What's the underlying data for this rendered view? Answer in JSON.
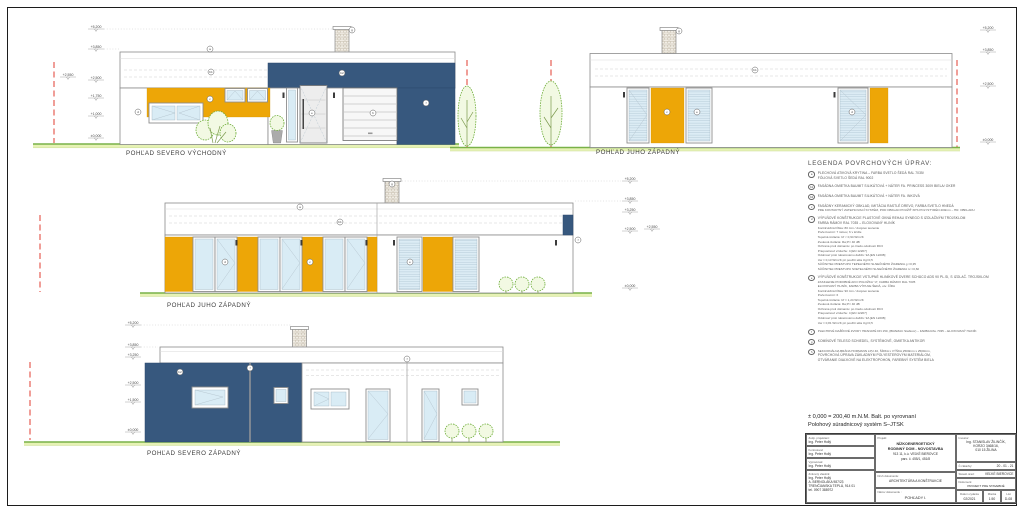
{
  "colors": {
    "facade_blue": "#37587e",
    "facade_yellow": "#eda607",
    "grass_green": "#79b148",
    "boundary_red": "#e23c30"
  },
  "drawing": {
    "elevations": [
      {
        "label": "POHĽAD  SEVERO VÝCHODNÝ"
      },
      {
        "label": "POHĽAD JUHO ZÁPADNÝ"
      },
      {
        "label": "POHĽAD JUHO ZÁPADNÝ"
      },
      {
        "label": "POHĽAD SEVERO ZÁPADNÝ"
      }
    ],
    "level_marks": [
      {
        "x": 96,
        "y": 29,
        "label": "+5,200",
        "leader": [
          104,
          332
        ]
      },
      {
        "x": 96,
        "y": 49,
        "label": "+3,850",
        "leader": [
          104,
          119
        ]
      },
      {
        "x": 68,
        "y": 77,
        "label": "+2,550"
      },
      {
        "x": 96,
        "y": 80,
        "label": "+2,500"
      },
      {
        "x": 96,
        "y": 98,
        "label": "+1,750"
      },
      {
        "x": 96,
        "y": 116,
        "label": "+1,000"
      },
      {
        "x": 96,
        "y": 138,
        "label": "±0,000"
      },
      {
        "x": 988,
        "y": 30,
        "label": "+5,200"
      },
      {
        "x": 988,
        "y": 52,
        "label": "+3,850"
      },
      {
        "x": 988,
        "y": 86,
        "label": "+2,500"
      },
      {
        "x": 988,
        "y": 142,
        "label": "±0,000"
      },
      {
        "x": 630,
        "y": 181,
        "label": "+5,200",
        "leader": [
          402,
          621
        ]
      },
      {
        "x": 630,
        "y": 201,
        "label": "+3,850",
        "leader": [
          575,
          621
        ]
      },
      {
        "x": 630,
        "y": 212,
        "label": "+3,250"
      },
      {
        "x": 630,
        "y": 231,
        "label": "+2,500"
      },
      {
        "x": 652,
        "y": 229,
        "label": "+2,550"
      },
      {
        "x": 630,
        "y": 288,
        "label": "±0,000"
      },
      {
        "x": 133,
        "y": 325,
        "label": "+5,200",
        "leader": [
          141,
          291
        ]
      },
      {
        "x": 133,
        "y": 347,
        "label": "+3,850",
        "leader": [
          141,
          158
        ]
      },
      {
        "x": 133,
        "y": 357,
        "label": "+3,250"
      },
      {
        "x": 133,
        "y": 385,
        "label": "+2,500"
      },
      {
        "x": 133,
        "y": 402,
        "label": "+1,500"
      },
      {
        "x": 133,
        "y": 432,
        "label": "±0,000"
      }
    ],
    "markers": [
      {
        "x": 210,
        "y": 49,
        "label": "a"
      },
      {
        "x": 211,
        "y": 72,
        "label": "b1"
      },
      {
        "x": 342,
        "y": 73,
        "label": "b2"
      },
      {
        "x": 210,
        "y": 99,
        "label": "c"
      },
      {
        "x": 138,
        "y": 112,
        "label": "d"
      },
      {
        "x": 312,
        "y": 113,
        "label": "e"
      },
      {
        "x": 373,
        "y": 113,
        "label": "h"
      },
      {
        "x": 352,
        "y": 30,
        "label": "g"
      },
      {
        "x": 426,
        "y": 103,
        "label": "f"
      },
      {
        "x": 679,
        "y": 31,
        "label": "g"
      },
      {
        "x": 755,
        "y": 70,
        "label": "b1"
      },
      {
        "x": 667,
        "y": 112,
        "label": "c"
      },
      {
        "x": 697,
        "y": 112,
        "label": "e"
      },
      {
        "x": 852,
        "y": 112,
        "label": "d"
      },
      {
        "x": 300,
        "y": 207,
        "label": "a"
      },
      {
        "x": 340,
        "y": 222,
        "label": "b1"
      },
      {
        "x": 225,
        "y": 262,
        "label": "d"
      },
      {
        "x": 310,
        "y": 262,
        "label": "c"
      },
      {
        "x": 410,
        "y": 262,
        "label": "e"
      },
      {
        "x": 578,
        "y": 240,
        "label": "f"
      },
      {
        "x": 392,
        "y": 184,
        "label": "g"
      },
      {
        "x": 180,
        "y": 372,
        "label": "b2"
      },
      {
        "x": 250,
        "y": 368,
        "label": "f"
      },
      {
        "x": 407,
        "y": 359,
        "label": "f"
      }
    ]
  },
  "legend": {
    "title": "LEGENDA  POVRCHOVÝCH  ÚPRAV:",
    "items": [
      {
        "key": "a",
        "lines": [
          "PLECHOVÁ ATIKOVÁ KRYTINA – FARBA SVETLO ŠEDÁ RAL 7035/",
          "FÓLIOVÁ SVETLO ŠEDÁ RAL 9002"
        ]
      },
      {
        "key": "b1",
        "lines": [
          "FASÁDNA OMIETKA BAUMIT SILIKÁTOVÁ + NÁTER FA. PRINCESS 3009 BIELA/ OKER"
        ]
      },
      {
        "key": "b2",
        "lines": [
          "FASÁDNA OMIETKA BAUMIT SILIKÁTOVÁ + NÁTER FA. INKOVÁ"
        ]
      },
      {
        "key": "c",
        "lines": [
          "FASÁDNY KERAMICKÝ OBKLAD, IMITÁCIA RASTLÉ DREVO, FARBA SVETLO HNEDÁ",
          "PRE KONTAKTNÝ ZATEPĽOVACÍ SYSTÉM, POD OBKLAD POUŽIŤ XPS POLYSTYRÉN 200mm – HR. OBKLADU"
        ]
      },
      {
        "key": "d",
        "lines": [
          "VÝPLŇOVÉ KONŠTRUKCIE PLASTOVÉ OKNÁ REHAU SYNEGO S IZOLAČNÝM TROJSKLOM",
          "FARBA RÁMOV RAL 7035 – ELOXOVANÝ HLINÍK",
          "Konštrukčná hĺbka: 80 mm / dvojové tesnenie",
          "Počet komôr: 7 rámov, 6 v krídle",
          "Tepelná izolácia: Uf < 0,94 W/m²K",
          "Zvuková izolácia: Rw,P= 40 dB",
          "Ochrana proti vlámaniu: po triedu odolnosti RC3",
          "Priepustnosť vzduchu: 4 [EN 12207]",
          "Odolnosť proti nárazovému dažďu: 9A [EN 12208]",
          "Uw = 0,13 W/m²K pri použití skla Ug=0,5",
          "SÚČINITEĽ PRESTUPU TEPELNÉHO SLNEČNÉHO ŽIARENIA g =0,35",
          "SÚČINITEĽ PRESTUPU SVETELNÉHO SLNEČNÉHO ŽIARENIA τv =0,60"
        ]
      },
      {
        "key": "e",
        "lines": [
          "VÝPLŇOVÉ KONŠTRUKCIE VSTUPNÉ HLINÍKOVÉ DVERE SCHÜCO ADS 90 PL.SI, S IZOLAČ. TROJSKLOM",
          "ZASKLENIE PODOBNÉ AKO POLOŽKA \"d\", FARBA RÁMOV RAL 7035",
          "ELOXOVANÝ HLINÍK, FARBA VÝPLNE ŠEDÁ, otv. ČÍRA",
          "Konštrukčná hĺbka: 90 mm / dvojové tesnenie",
          "Počet komôr: 6",
          "Tepelná izolácia: Uf = 1,24 W/m²K",
          "Zvuková izolácia: Rw,P= 40 dB",
          "Ochrana proti vlámaniu: po triedu odolnosti RC3",
          "Priepustnosť vzduchu: 4 [EN 12207]",
          "Odolnosť proti nárazovému dažďu: 9A [EN 12208]",
          "Uw = 0,81 W/m²K pri použití skla Ug=0,5"
        ]
      },
      {
        "key": "f",
        "lines": [
          "PLECHOVÉ DAŽĎOVÉ ZVODY HRANATÉ DN 150, (BRAMAC Stabicor) – FARBA RAL 7035 – ELOXOVANÝ HLINÍK"
        ]
      },
      {
        "key": "g",
        "lines": [
          "KOMÍNOVÉ TELESO SCHIEDEL, SYSTÉMOVÉ, OMIETKA ANTIKOR"
        ]
      },
      {
        "key": "h",
        "lines": [
          "SEKCIONÁLNA BRÁNA HORMANN LPU 40, ŠÍRKA x VÝŠKA 2500mm x 2500mm,",
          "POVRCHOVÁ ÚPRAVA ZÁKLADNÝM POLYESTEROVÝM MATERIÁLOM,",
          "OTVÁRANIE DIAĽKOVÉ NA ELEKTROPOHON, FAREBNÝ SYSTÉM BIELA"
        ]
      }
    ]
  },
  "datum": {
    "line1": "± 0,000 = 200,40 m.N.M. Balt. po vyrovnaní",
    "line2": "Polohový súradnicový systém  S–JTSK"
  },
  "titleblock": {
    "roles": [
      {
        "label": "Zodp. projektant:",
        "value": "Ing. Peter Hollý"
      },
      {
        "label": "Kontroloval:",
        "value": "Ing. Peter Hollý"
      },
      {
        "label": "Vypracoval:",
        "value": "Ing. Peter Hollý"
      }
    ],
    "firm": {
      "label": "Zmluvný vlastník:",
      "lines": [
        "Ing. Peter Hollý",
        "A. BERNOLÁKA 987/23",
        "TRENČIANSKA TEPLÁ, 914 01",
        "tel. 0907 388972"
      ]
    },
    "project": {
      "label": "Projekt:",
      "lines": [
        "NÍZKOENERGETICKÝ",
        "RODINNÝ DOM - NOVOSTAVBA",
        "913 11, k.ú. VEĽKÉ BIEROVCE",
        "parc. č. 455/1, 451/8"
      ]
    },
    "doc_type": {
      "label": "Druh dokumentu:",
      "value": "ARCHITEKTÚRA A KONŠTRUKCIE"
    },
    "doc_name": {
      "label": "Názov dokumentu :",
      "value": "POHĽADY I."
    },
    "investor": {
      "label": "Investor:",
      "lines": [
        "Ing. STANISLAV ŽILINČÍK,",
        "KORZO 3468/16,",
        "010 15 ŽILINA"
      ]
    },
    "order": {
      "label": "Č.zákazky:",
      "value": "20 - 01 - 21"
    },
    "office": {
      "label": "Staveb.úrad:",
      "value": "VEĽKÉ BIEROVCE"
    },
    "document": {
      "label": "Dokument:",
      "value": "PROJEKT PRE STAVEBNÉ POVOLENIE"
    },
    "date": {
      "label": "Dátum  vydania",
      "value": "02/2021"
    },
    "scale": {
      "label": "Mierka",
      "value": "1:50"
    },
    "list": {
      "label": "List",
      "value": "D-08"
    }
  }
}
